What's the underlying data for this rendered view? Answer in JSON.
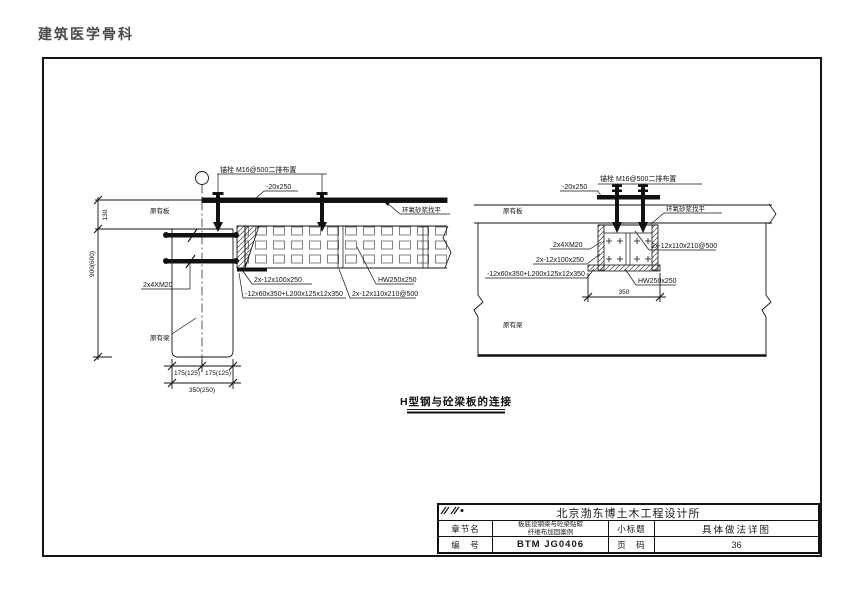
{
  "page": {
    "header": "建筑医学骨科"
  },
  "drawing": {
    "title": "H型钢与砼梁板的连接",
    "left": {
      "anchor_label": "锚栓 M16@500二排布置",
      "plate_label": "-20x250",
      "slab_label": "原有板",
      "mortar_label": "环氧砂浆找平",
      "bolts_label": "2x4XM20",
      "beam_label": "原有梁",
      "dim_130": "130",
      "dim_900": "900(600)",
      "dim_175_left": "175(125)",
      "dim_175_right": "175(125)",
      "dim_350": "350(250)",
      "packing_label": "2x-12x100x250",
      "bottom_plate_label": "-12x60x350+L200x125x12x350",
      "stiffener_label": "2x-12x110x210@500",
      "hbeam_label": "HW250x250"
    },
    "right": {
      "anchor_label": "锚栓 M16@500二排布置",
      "plate_label": "-20x250",
      "slab_label": "原有板",
      "mortar_label": "环氧砂浆找平",
      "bolts_label": "2x4XM20",
      "beam_label": "原有梁",
      "packing_label": "2x-12x100x250",
      "bottom_plate_label": "-12x60x350+L200x125x12x350",
      "stiffener_label": "2x-12x110x210@500",
      "hbeam_label": "HW250x250",
      "dim_350": "350"
    }
  },
  "title_block": {
    "company": "北京渤东博土木工程设计所",
    "chapter_label": "章节名",
    "chapter_line1": "板底设钢梁与砼梁贴碳",
    "chapter_line2": "纤维布加固案例",
    "subtitle_label": "小标题",
    "subtitle_value": "具体做法详图",
    "number_label": "编　号",
    "number_value": "BTM JG0406",
    "page_label": "页　码",
    "page_value": "36"
  },
  "colors": {
    "line": "#111111",
    "hatch": "#808080"
  }
}
